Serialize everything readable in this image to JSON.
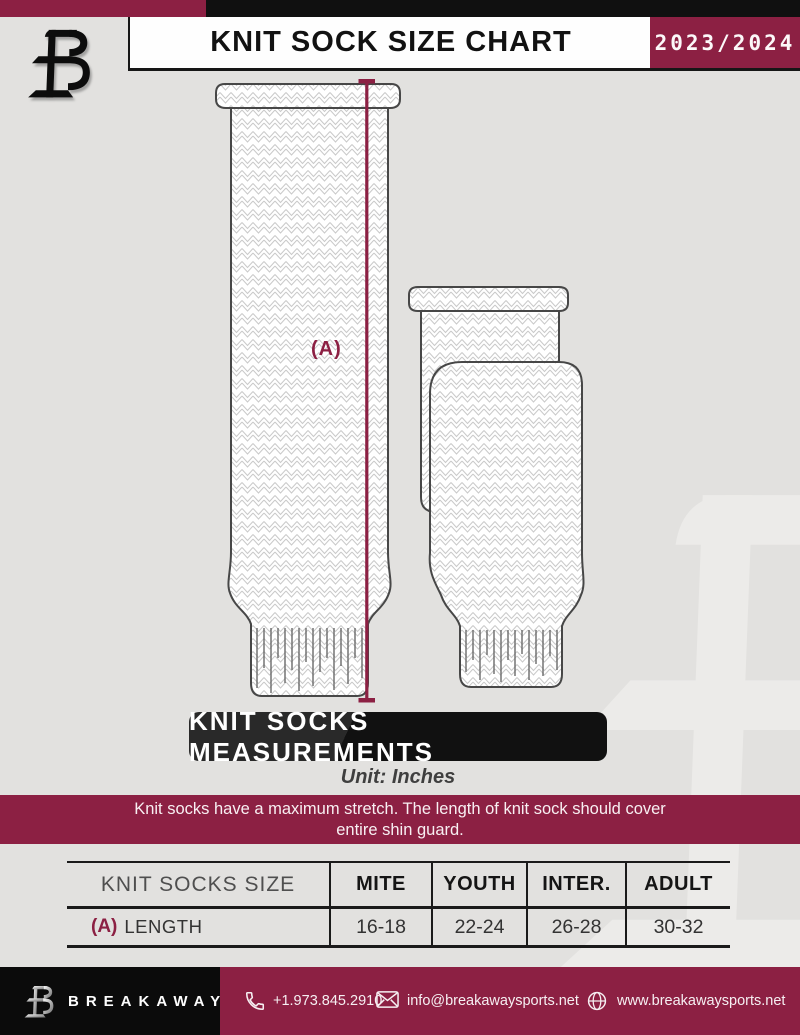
{
  "colors": {
    "accent": "#8C2043",
    "background": "#E2E1DF",
    "black": "#101010"
  },
  "header": {
    "title": "KNIT SOCK SIZE CHART",
    "season": "2023/2024"
  },
  "diagram": {
    "measurement_label": "(A)"
  },
  "measurements_banner": "KNIT SOCKS MEASUREMENTS",
  "unit_note": "Unit: Inches",
  "stretch_note": {
    "line1": "Knit socks have a maximum stretch. The length of knit sock should cover",
    "line2": "entire shin guard."
  },
  "size_table": {
    "headers": [
      "KNIT SOCKS SIZE",
      "MITE",
      "YOUTH",
      "INTER.",
      "ADULT"
    ],
    "rows": [
      {
        "label_key": "(A)",
        "label": "LENGTH",
        "values": [
          "16-18",
          "22-24",
          "26-28",
          "30-32"
        ]
      }
    ]
  },
  "footer": {
    "brand": "BREAKAWAY",
    "phone": "+1.973.845.2910",
    "email": "info@breakawaysports.net",
    "website": "www.breakawaysports.net"
  }
}
